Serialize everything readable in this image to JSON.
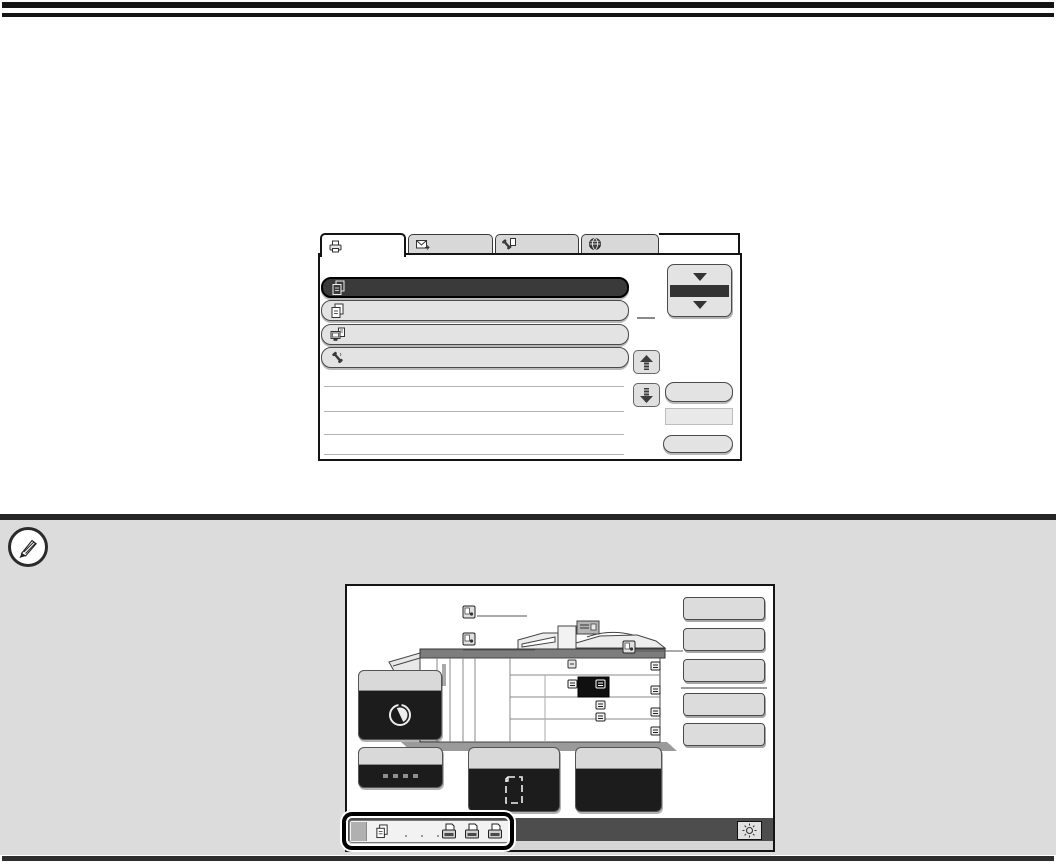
{
  "document": {
    "kind": "printer-operation-guide-page",
    "top_rules": 2,
    "bottom_rules": 1,
    "visible_text": ""
  },
  "colors": {
    "ink": "#141414",
    "screen-border": "#141414",
    "note-bg": "#dcdcdc",
    "note-bar": "#262626",
    "tab-gray": "#d8d8d8",
    "row-gray": "#e3e3e3",
    "row-selected": "#3a3a3a",
    "button-gray": "#dcdcdc",
    "dark-panel": "#1c1c1c",
    "sysbar": "#4d4d4d",
    "line-gray": "#b3b3b3"
  },
  "job_status_screen": {
    "tabs": [
      {
        "id": "print-jobs",
        "icon": "printer-icon",
        "active": true,
        "label": ""
      },
      {
        "id": "scan-send-jobs",
        "icon": "envelope-send-icon",
        "active": false,
        "label": ""
      },
      {
        "id": "fax-jobs",
        "icon": "fax-handset-icon",
        "active": false,
        "label": ""
      },
      {
        "id": "internet-fax-jobs",
        "icon": "globe-icon",
        "active": false,
        "label": ""
      }
    ],
    "job_rows": [
      {
        "icon": "copy-pages-icon",
        "selected": true,
        "label": ""
      },
      {
        "icon": "copy-pages-icon",
        "selected": false,
        "label": ""
      },
      {
        "icon": "pc-print-icon",
        "selected": false,
        "label": ""
      },
      {
        "icon": "phone-handset-icon",
        "selected": false,
        "label": ""
      }
    ],
    "empty_row_lines": 4,
    "scroll_selector": {
      "style": "two-down-triangles-with-dark-band"
    },
    "scroll_buttons": [
      "up-arrow",
      "down-arrow"
    ],
    "blank_keys": 3
  },
  "system_screen": {
    "machine_illustration": {
      "type": "copier-side-view",
      "callout_markers": 3,
      "operation_panel_marker": true,
      "highlighted_unit": true,
      "drawer_handles": 8
    },
    "right_keys": 5,
    "right_key_divider_after": 3,
    "toner_key": {
      "icon": "toner-cartridge-icon",
      "label": ""
    },
    "bottom_keys": [
      {
        "icon": "paper-size-marks",
        "label": ""
      },
      {
        "icon": "page-outline-icon",
        "label": ""
      },
      {
        "icon": "none",
        "label": ""
      }
    ],
    "status_bar": {
      "square_indicator": true,
      "icon": "copy-pages-icon",
      "dot_count": 3,
      "job_status_icons": 3,
      "brightness_key_icon": "sun-icon",
      "highlight_callout": true
    }
  },
  "note_section": {
    "icon": "pencil-circle-icon",
    "text": ""
  }
}
